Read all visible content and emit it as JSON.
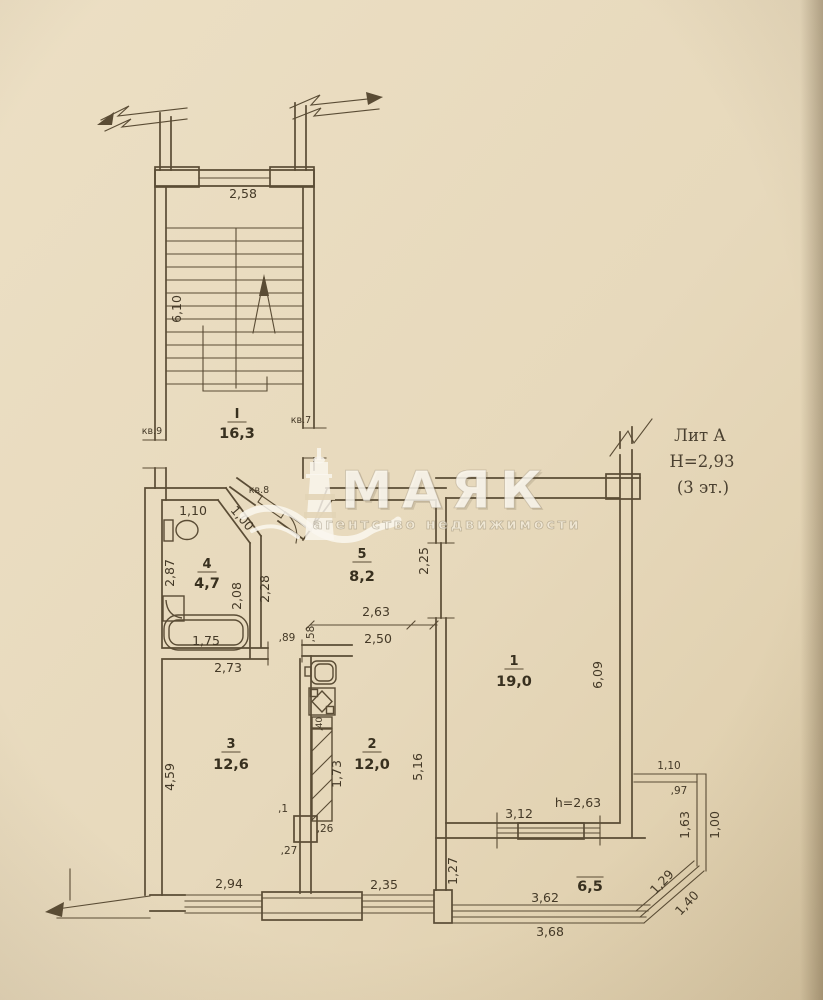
{
  "watermark": {
    "brand": "МАЯК",
    "tagline": "агентство недвижимости"
  },
  "title_block": {
    "liter": "Лит А",
    "height": "Н=2,93",
    "floor": "(3 эт.)"
  },
  "stairwell": {
    "room_no": "I",
    "room_area": "16,3",
    "dims": {
      "width": "2,58",
      "flight": "6,10"
    },
    "flats": {
      "left": "кв.9",
      "right": "кв.7",
      "entry": "кв.8"
    }
  },
  "bathroom": {
    "room_no": "4",
    "room_area": "4,7",
    "dims": {
      "top": "1,10",
      "diagonal": "1,00",
      "left": "2,87",
      "inner_right": "2,08",
      "outer_right": "2,28",
      "tub": "1,75"
    }
  },
  "hallway": {
    "room_no": "5",
    "room_area": "8,2",
    "dims": {
      "length": "2,25",
      "width_top": "2,63",
      "width_bottom": "2,50",
      "door": ",89",
      "jamb": ",58"
    }
  },
  "living_room": {
    "room_no": "1",
    "room_area": "19,0",
    "dims": {
      "depth": "6,09",
      "window": "3,12",
      "ceiling": "h=2,63"
    }
  },
  "room3": {
    "room_no": "3",
    "room_area": "12,6",
    "dims": {
      "top": "2,73",
      "left": "4,59",
      "bottom": "2,94"
    }
  },
  "kitchen": {
    "room_no": "2",
    "room_area": "12,0",
    "dims": {
      "right": "5,16",
      "bottom": "2,35",
      "duct": "1,73",
      "duct_width": ",40",
      "note1": ",1",
      "note2": ",26",
      "note3": ",27"
    }
  },
  "balcony": {
    "area": "6,5",
    "dims": {
      "left": "1,27",
      "bottom_inner": "3,62",
      "bottom_outer": "3,68",
      "diag_inner": "1,29",
      "diag_outer": "1,40",
      "right_inner": "1,63",
      "right_outer": "1,00",
      "top": "1,10",
      "offset": ",97"
    }
  }
}
